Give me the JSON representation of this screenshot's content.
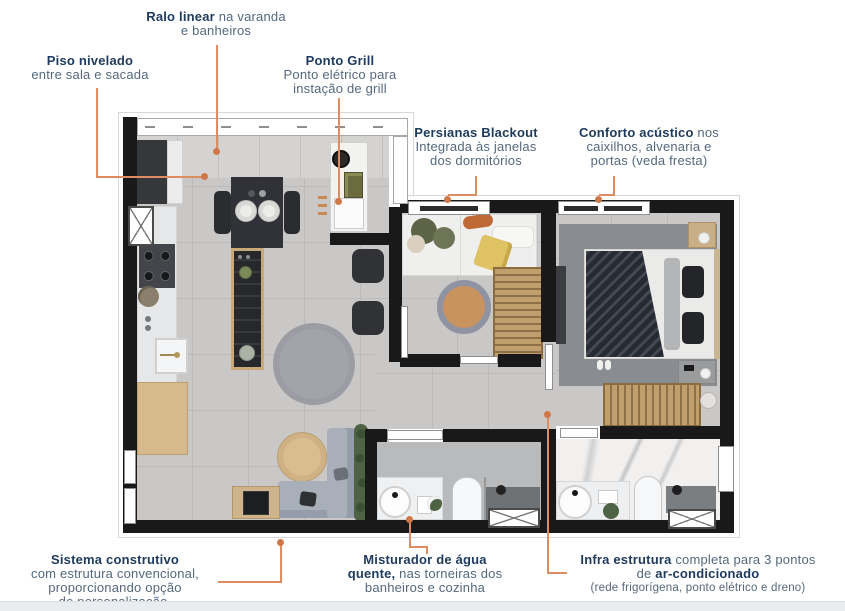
{
  "colors": {
    "accent": "#dd8d61",
    "accent-dark": "#d1784a",
    "navy": "#1e3a5c",
    "text": "#54687d",
    "wall": "#191919",
    "floor": "#c9c8c6",
    "floor-line": "#bcbbb9",
    "varanda": "#d4d3d1",
    "bath-floor": "#b9babc",
    "marble": "#f1f0ee",
    "wood": "#d6ba8e",
    "wood-dark": "#c19f6d",
    "dark-furn": "#2e3034",
    "sofa": "#a9afb9",
    "rug": "#9c9ca4",
    "rug-tan": "#c8935f",
    "white-furn": "#f2f2f1",
    "band": "#e9edf0",
    "green": "#4d6344",
    "olive": "#5c6347"
  },
  "callouts": {
    "ralo": {
      "bold": "Ralo linear",
      "rest": " na varanda",
      "line2": "e banheiros"
    },
    "piso": {
      "bold": "Piso nivelado",
      "line2": "entre sala e sacada"
    },
    "grill": {
      "bold": "Ponto Grill",
      "line2": "Ponto elétrico para",
      "line3": "instação de grill"
    },
    "persianas": {
      "bold": "Persianas Blackout",
      "line2": "Integrada às janelas",
      "line3": "dos dormitórios"
    },
    "conforto": {
      "bold": "Conforto acústico",
      "rest": " nos",
      "line2": "caixilhos, alvenaria e",
      "line3": "portas (veda fresta)"
    },
    "sistema": {
      "bold": "Sistema construtivo",
      "line2": "com estrutura convencional,",
      "line3": "proporcionando opção",
      "line4": "de personalização."
    },
    "misturador": {
      "bold": "Misturador de água",
      "line2_bold": "quente,",
      "line2_rest": " nas torneiras dos",
      "line3": "banheiros e cozinha"
    },
    "infra": {
      "bold": "Infra estrutura",
      "rest": " completa para 3 pontos",
      "line2_pre": "de ",
      "line2_bold": "ar-condicionado",
      "line3": "(rede frigorígena, ponto elétrico e dreno)"
    }
  }
}
